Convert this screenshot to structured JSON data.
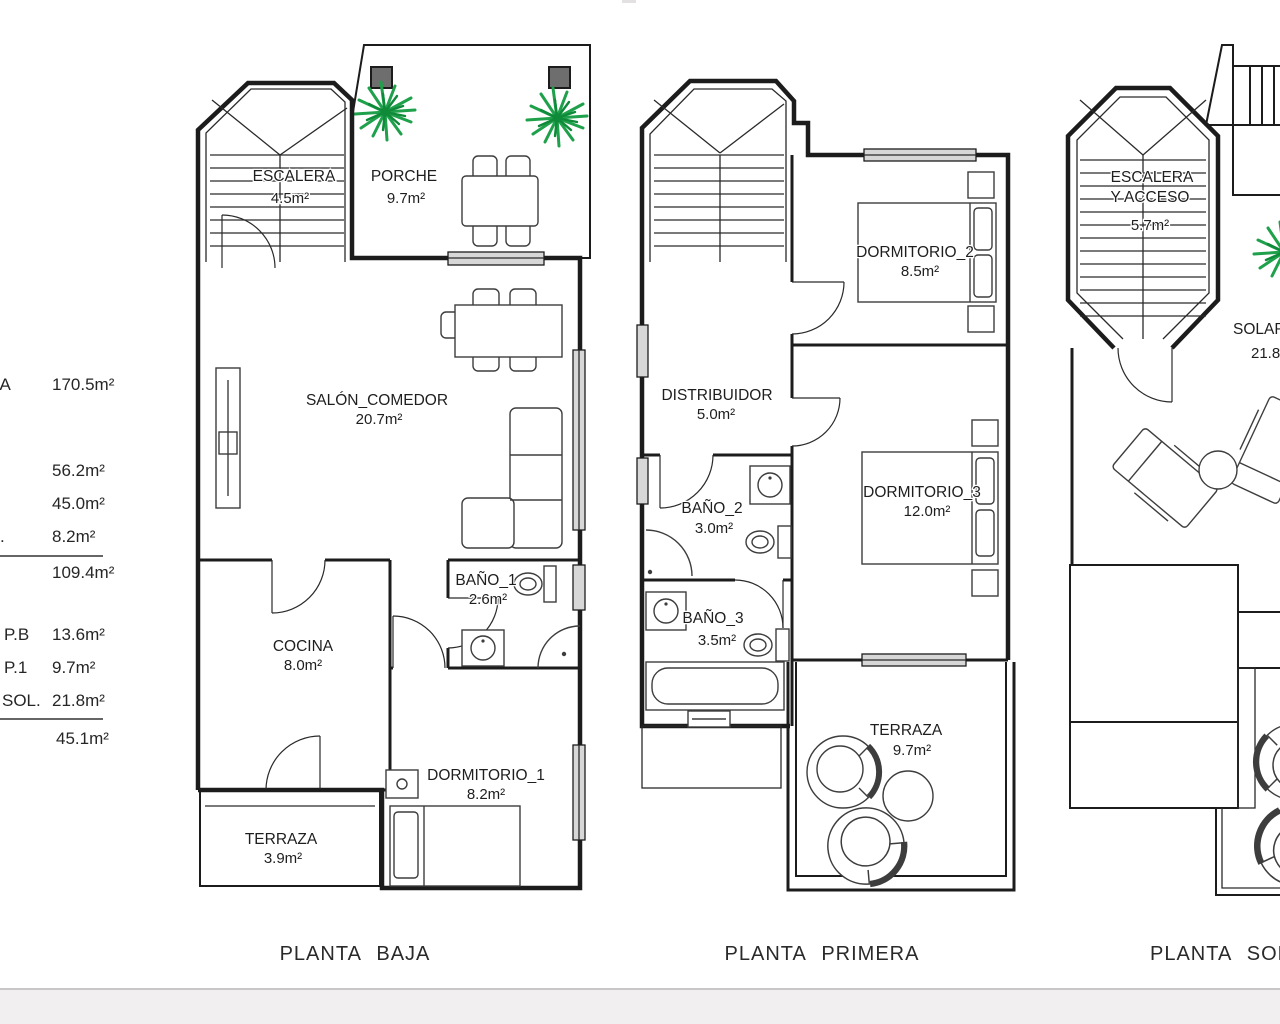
{
  "colors": {
    "line": "#1c1c1c",
    "hatch": "#b7b5b2",
    "tile": "#b2afab",
    "tile_bg": "#f7f6f4",
    "plant": "#1fa04b",
    "plant_dark": "#0e8a39",
    "window": "#d7d7d7",
    "footer_band": "#f1efef",
    "divider": "#c8c6c6"
  },
  "summary": {
    "rows": [
      {
        "label": "LA",
        "value": "170.5m²"
      },
      {
        "label": "",
        "value": "56.2m²"
      },
      {
        "label": "",
        "value": "45.0m²"
      },
      {
        "label": ".",
        "value": "8.2m²"
      },
      {
        "label": "",
        "value": "109.4m²"
      },
      {
        "label": "P.B",
        "value": "13.6m²"
      },
      {
        "label": "P.1",
        "value": "9.7m²"
      },
      {
        "label": "SOL.",
        "value": "21.8m²"
      },
      {
        "label": "",
        "value": "45.1m²"
      }
    ]
  },
  "plans": {
    "baja": {
      "title": "PLANTA BAJA",
      "rooms": {
        "escalera": {
          "name": "ESCALERA",
          "area": "4.5m²"
        },
        "porche": {
          "name": "PORCHE",
          "area": "9.7m²"
        },
        "salon": {
          "name": "SALÓN_COMEDOR",
          "area": "20.7m²"
        },
        "cocina": {
          "name": "COCINA",
          "area": "8.0m²"
        },
        "bano1": {
          "name": "BAÑO_1",
          "area": "2.6m²"
        },
        "dormitorio1": {
          "name": "DORMITORIO_1",
          "area": "8.2m²"
        },
        "terraza": {
          "name": "TERRAZA",
          "area": "3.9m²"
        }
      }
    },
    "primera": {
      "title": "PLANTA PRIMERA",
      "rooms": {
        "dormitorio2": {
          "name": "DORMITORIO_2",
          "area": "8.5m²"
        },
        "distribuidor": {
          "name": "DISTRIBUIDOR",
          "area": "5.0m²"
        },
        "bano2": {
          "name": "BAÑO_2",
          "area": "3.0m²"
        },
        "dormitorio3": {
          "name": "DORMITORIO_3",
          "area": "12.0m²"
        },
        "bano3": {
          "name": "BAÑO_3",
          "area": "3.5m²"
        },
        "terraza": {
          "name": "TERRAZA",
          "area": "9.7m²"
        }
      }
    },
    "solarium": {
      "title": "PLANTA SOLARIUM",
      "rooms": {
        "escalera_acceso": {
          "name_line1": "ESCALERA",
          "name_line2": "Y ACCESO",
          "area": "5.7m²"
        },
        "solarium": {
          "name": "SOLARIUM",
          "area": "21.8m²"
        }
      }
    }
  }
}
